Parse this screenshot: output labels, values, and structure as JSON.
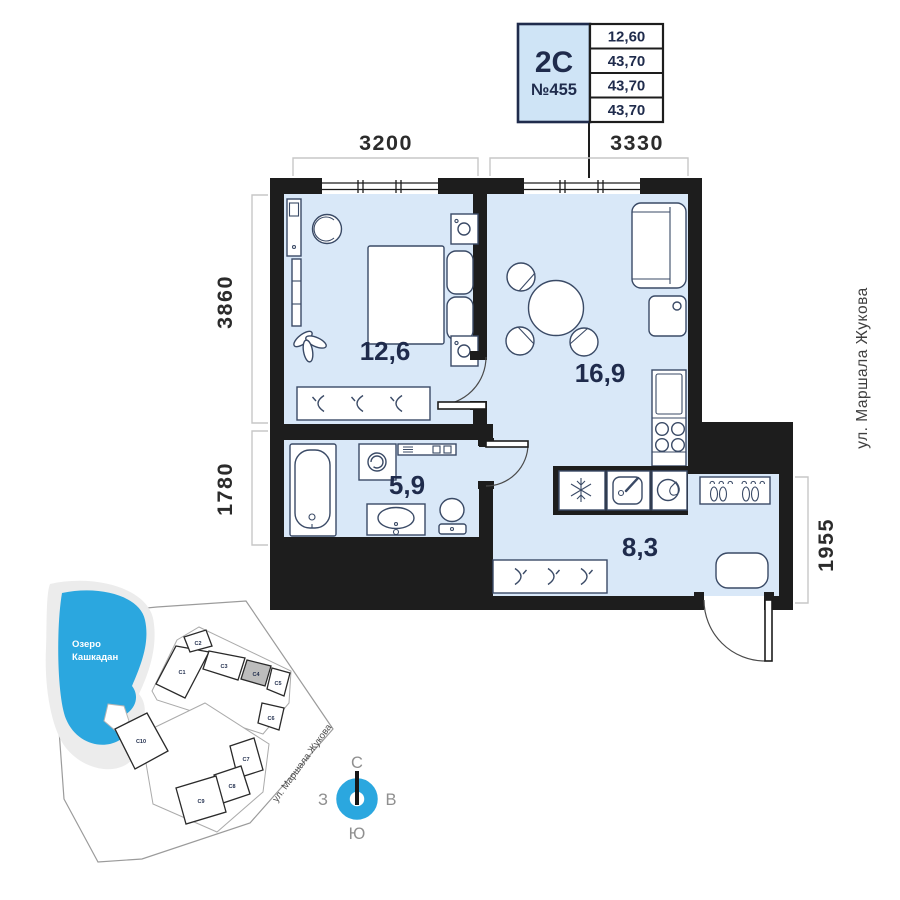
{
  "unit_card": {
    "type_label": "2С",
    "number_label": "№455",
    "table_values": [
      "12,60",
      "43,70",
      "43,70",
      "43,70"
    ]
  },
  "dimensions": {
    "top_left_width": "3200",
    "top_right_width": "3330",
    "left_upper_height": "3860",
    "left_lower_height": "1780",
    "right_height": "1955"
  },
  "street_label_right": "ул. Маршала Жукова",
  "rooms": {
    "bedroom_area": "12,6",
    "living_kitchen_area": "16,9",
    "bathroom_area": "5,9",
    "hallway_area": "8,3"
  },
  "site_map": {
    "lake_label_line1": "Озеро",
    "lake_label_line2": "Кашкадан",
    "street_label": "ул. Маршала Жукова",
    "buildings": [
      "С1",
      "С2",
      "С3",
      "С4",
      "С5",
      "С6",
      "С7",
      "С8",
      "С9",
      "С10"
    ],
    "highlighted_building": "С4"
  },
  "compass": {
    "north": "С",
    "east": "В",
    "south": "Ю",
    "west": "З"
  },
  "colors": {
    "floor_fill": "#d9e8f8",
    "walls": "#1d1d1d",
    "accent_blue": "#2ba7df",
    "navy_text": "#1f2b4c",
    "unit_card_fill": "#cfe4f6",
    "highlighted_building_fill": "#bdbdbd",
    "dimension_text": "#2b2b2b",
    "shore_gray": "#ececec"
  }
}
